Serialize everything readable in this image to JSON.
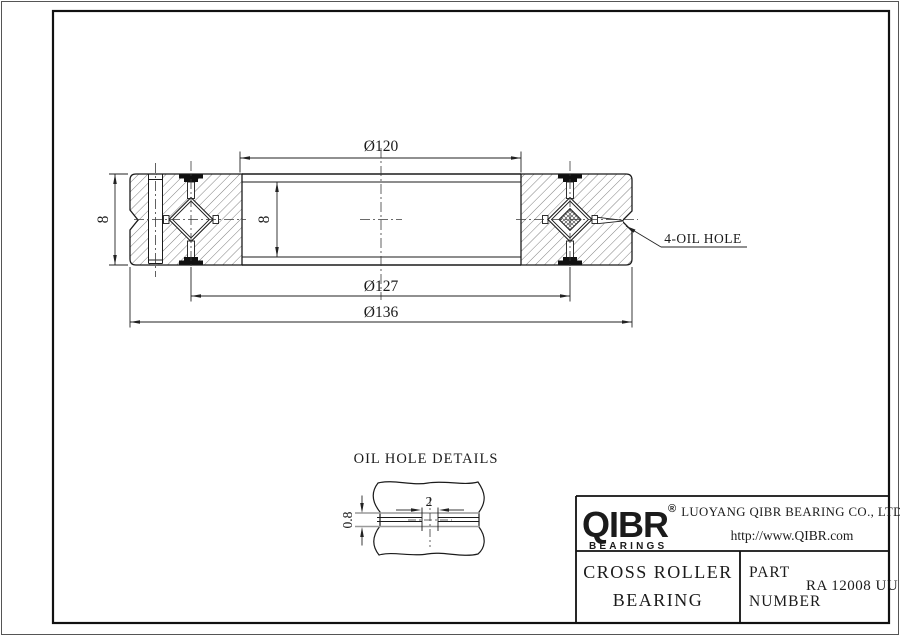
{
  "drawing": {
    "dim_bore": "Ø120",
    "dim_pitch": "Ø127",
    "dim_od": "Ø136",
    "dim_width_outer": "8",
    "dim_width_inner": "8",
    "oil_hole_note": "4-OIL HOLE",
    "detail": {
      "title": "OIL HOLE DETAILS",
      "dim_hole_width": "2",
      "dim_hole_depth": "0.8"
    }
  },
  "title_block": {
    "logo_text": "QIBR",
    "logo_reg": "®",
    "logo_sub": "BEARINGS",
    "company": "LUOYANG QIBR BEARING CO., LTD",
    "website": "http://www.QIBR.com",
    "product_line1": "CROSS ROLLER",
    "product_line2": "BEARING",
    "part_label1": "PART",
    "part_label2": "NUMBER",
    "part_number": "RA 12008 UU"
  },
  "colors": {
    "line": "#1b1b1b",
    "gray_line": "#9a9a9a",
    "background": "#ffffff"
  }
}
